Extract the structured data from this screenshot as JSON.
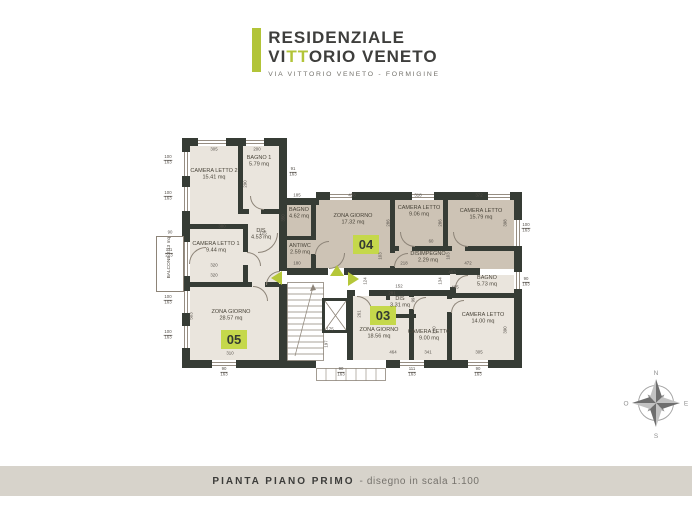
{
  "header": {
    "line1": "RESIDENZIALE",
    "line2_pre": "VI",
    "line2_green": "TT",
    "line2_post": "ORIO VENETO",
    "subtitle": "VIA VITTORIO VENETO - FORMIGINE"
  },
  "footer": {
    "title": "PIANTA PIANO PRIMO",
    "subtitle": "- disegno in scala 1:100"
  },
  "compass": {
    "north": "N",
    "south": "S",
    "east": "E",
    "west": "O"
  },
  "colors": {
    "accent_green": "#b2c438",
    "badge_green": "#c5d84b",
    "wall": "#363c35",
    "apt04_fill": "#cdc3b5",
    "apt_light_fill": "#eae5dd",
    "footer_band": "#d7d3cb"
  },
  "apartments": [
    {
      "id": "05",
      "badge": {
        "x": 221,
        "y": 330
      },
      "rooms": [
        {
          "name": "CAMERA LETTO 2",
          "area": "15.41 mq",
          "x": 214,
          "y": 175
        },
        {
          "name": "BAGNO 1",
          "area": "5.79 mq",
          "x": 259,
          "y": 162
        },
        {
          "name": "DIS",
          "area": "4.53 mq",
          "x": 261,
          "y": 235
        },
        {
          "name": "CAMERA LETTO 1",
          "area": "9.44 mq",
          "x": 216,
          "y": 248
        },
        {
          "name": "ZONA GIORNO",
          "area": "28.57 mq",
          "x": 231,
          "y": 316
        }
      ]
    },
    {
      "id": "04",
      "badge": {
        "x": 353,
        "y": 235
      },
      "rooms": [
        {
          "name": "BAGNO",
          "area": "4.62 mq",
          "x": 299,
          "y": 214
        },
        {
          "name": "ANTIWC",
          "area": "2.59 mq",
          "x": 300,
          "y": 250
        },
        {
          "name": "ZONA GIORNO",
          "area": "17.32 mq",
          "x": 353,
          "y": 220
        },
        {
          "name": "CAMERA LETTO",
          "area": "9.06 mq",
          "x": 419,
          "y": 212
        },
        {
          "name": "CAMERA LETTO",
          "area": "15.79 mq",
          "x": 481,
          "y": 215
        },
        {
          "name": "DISIMPEGNO",
          "area": "2.29 mq",
          "x": 428,
          "y": 258
        }
      ]
    },
    {
      "id": "03",
      "badge": {
        "x": 370,
        "y": 306
      },
      "rooms": [
        {
          "name": "BAGNO",
          "area": "5.73 mq",
          "x": 487,
          "y": 282
        },
        {
          "name": "DIS",
          "area": "3.31 mq",
          "x": 400,
          "y": 303
        },
        {
          "name": "ZONA GIORNO",
          "area": "18.56 mq",
          "x": 379,
          "y": 334
        },
        {
          "name": "CAMERA LETTO",
          "area": "9.00 mq",
          "x": 429,
          "y": 336
        },
        {
          "name": "CAMERA LETTO",
          "area": "14.00 mq",
          "x": 483,
          "y": 319
        }
      ]
    }
  ],
  "plan": {
    "balcony": {
      "label": "BALCONE",
      "area": "2.13 mq"
    },
    "dims": [
      {
        "t": "305",
        "x": 214,
        "y": 150
      },
      {
        "t": "200",
        "x": 257,
        "y": 150
      },
      {
        "t": "91/163",
        "x": 293,
        "y": 172,
        "f": 1
      },
      {
        "t": "100/163",
        "x": 168,
        "y": 160,
        "f": 1
      },
      {
        "t": "100/163",
        "x": 168,
        "y": 196,
        "f": 1
      },
      {
        "t": "90",
        "x": 170,
        "y": 233
      },
      {
        "t": "111/223",
        "x": 169,
        "y": 253,
        "f": 1
      },
      {
        "t": "100/163",
        "x": 168,
        "y": 300,
        "f": 1
      },
      {
        "t": "100/163",
        "x": 168,
        "y": 335,
        "f": 1
      },
      {
        "t": "290",
        "x": 246,
        "y": 184,
        "r": 1
      },
      {
        "t": "380",
        "x": 222,
        "y": 227
      },
      {
        "t": "125",
        "x": 263,
        "y": 234
      },
      {
        "t": "320",
        "x": 214,
        "y": 266
      },
      {
        "t": "320",
        "x": 214,
        "y": 276
      },
      {
        "t": "503",
        "x": 192,
        "y": 316,
        "r": 1
      },
      {
        "t": "310",
        "x": 230,
        "y": 354
      },
      {
        "t": "185",
        "x": 297,
        "y": 196
      },
      {
        "t": "438",
        "x": 352,
        "y": 196
      },
      {
        "t": "318",
        "x": 418,
        "y": 196
      },
      {
        "t": "372",
        "x": 479,
        "y": 196
      },
      {
        "t": "350",
        "x": 284,
        "y": 218,
        "r": 1
      },
      {
        "t": "286",
        "x": 389,
        "y": 223,
        "r": 1
      },
      {
        "t": "286",
        "x": 441,
        "y": 223,
        "r": 1
      },
      {
        "t": "398",
        "x": 506,
        "y": 223,
        "r": 1
      },
      {
        "t": "60",
        "x": 431,
        "y": 242
      },
      {
        "t": "218",
        "x": 404,
        "y": 264
      },
      {
        "t": "180",
        "x": 297,
        "y": 264
      },
      {
        "t": "472",
        "x": 468,
        "y": 264
      },
      {
        "t": "103",
        "x": 381,
        "y": 256,
        "r": 1
      },
      {
        "t": "103",
        "x": 449,
        "y": 256,
        "r": 1
      },
      {
        "t": "100/163",
        "x": 526,
        "y": 228,
        "f": 1
      },
      {
        "t": "90/163",
        "x": 526,
        "y": 282,
        "f": 1
      },
      {
        "t": "463",
        "x": 452,
        "y": 273
      },
      {
        "t": "465",
        "x": 455,
        "y": 288
      },
      {
        "t": "152",
        "x": 399,
        "y": 287
      },
      {
        "t": "124",
        "x": 366,
        "y": 281,
        "r": 1
      },
      {
        "t": "134",
        "x": 441,
        "y": 281,
        "r": 1
      },
      {
        "t": "281",
        "x": 392,
        "y": 294
      },
      {
        "t": "261",
        "x": 360,
        "y": 314,
        "r": 1
      },
      {
        "t": "99",
        "x": 414,
        "y": 300,
        "r": 1
      },
      {
        "t": "175",
        "x": 330,
        "y": 330
      },
      {
        "t": "197",
        "x": 327,
        "y": 344,
        "r": 1
      },
      {
        "t": "280",
        "x": 435,
        "y": 330,
        "r": 1
      },
      {
        "t": "390",
        "x": 506,
        "y": 330,
        "r": 1
      },
      {
        "t": "464",
        "x": 393,
        "y": 353
      },
      {
        "t": "341",
        "x": 428,
        "y": 353
      },
      {
        "t": "305",
        "x": 479,
        "y": 353
      },
      {
        "t": "90/163",
        "x": 224,
        "y": 372,
        "f": 1
      },
      {
        "t": "90/163",
        "x": 341,
        "y": 372,
        "f": 1
      },
      {
        "t": "111/163",
        "x": 412,
        "y": 372,
        "f": 1
      },
      {
        "t": "90/163",
        "x": 478,
        "y": 372,
        "f": 1
      }
    ]
  }
}
